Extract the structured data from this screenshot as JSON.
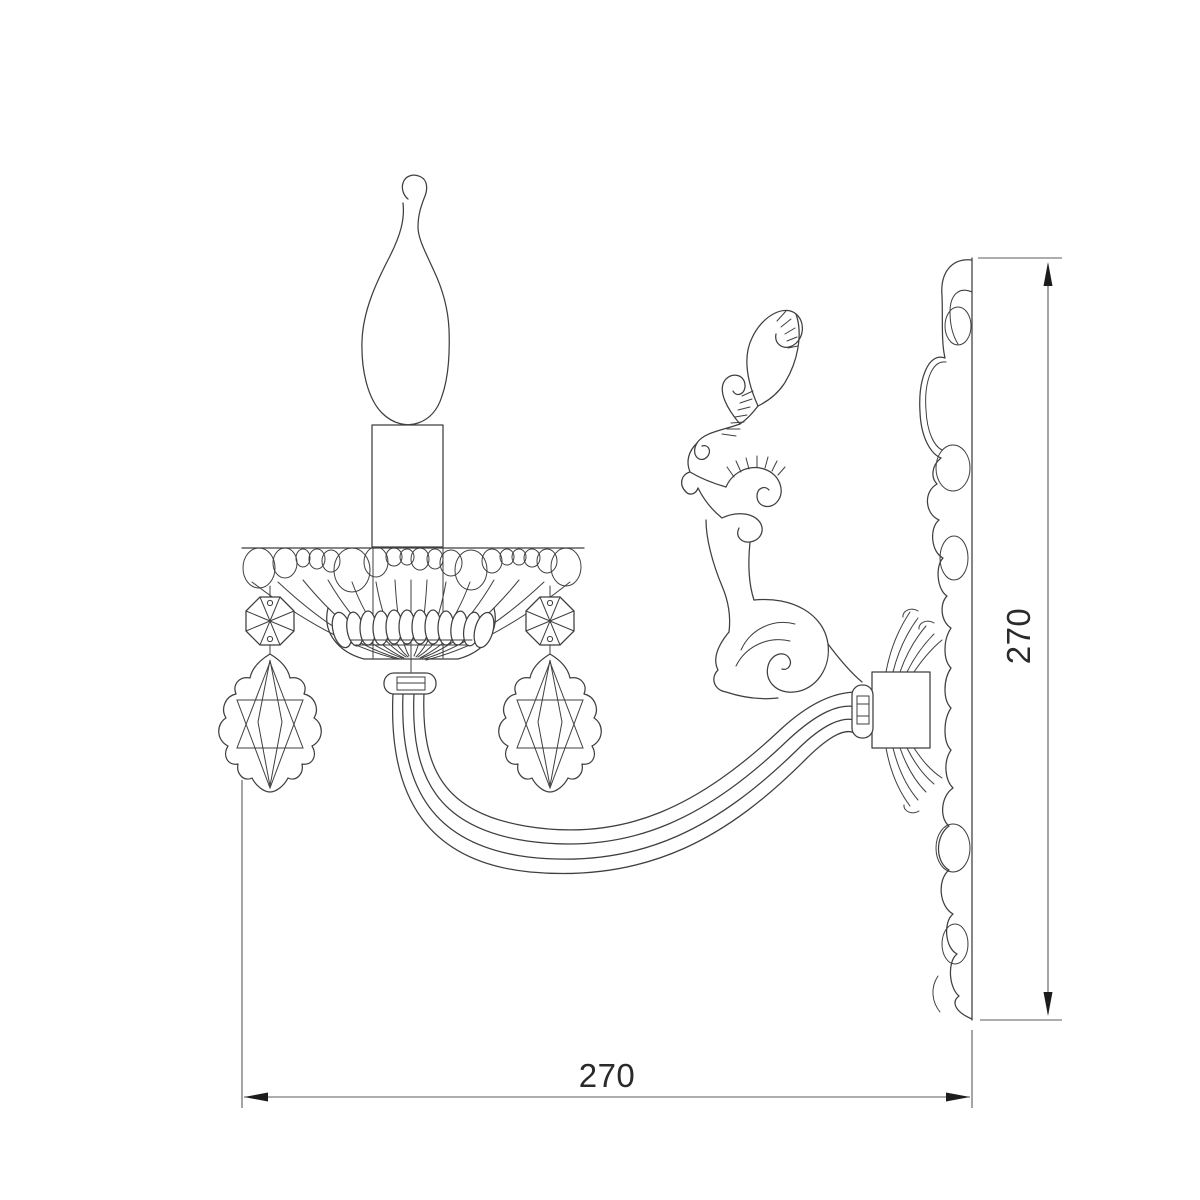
{
  "drawing": {
    "kind": "technical line drawing",
    "subject": "single-arm crystal wall sconce, side elevation"
  },
  "dimensions": {
    "width": {
      "label": "270"
    },
    "height": {
      "label": "270"
    }
  },
  "colors": {
    "line": "#3f3f3f",
    "dim": "#5b5b5b",
    "text": "#2a2a2a",
    "background": "#ffffff"
  }
}
